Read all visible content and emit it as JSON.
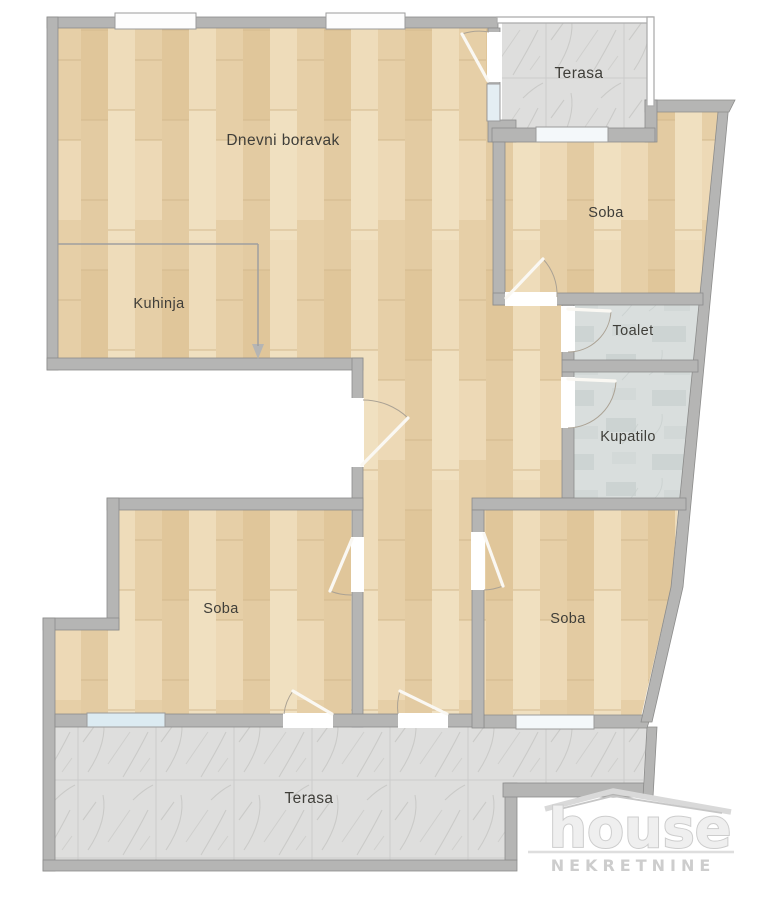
{
  "title": "Apartment floor plan",
  "plan": {
    "rooms": [
      {
        "id": "dnevni-boravak",
        "label": "Dnevni boravak"
      },
      {
        "id": "kuhinja",
        "label": "Kuhinja"
      },
      {
        "id": "terasa-top",
        "label": "Terasa"
      },
      {
        "id": "soba-top-right",
        "label": "Soba"
      },
      {
        "id": "toalet",
        "label": "Toalet"
      },
      {
        "id": "kupatilo",
        "label": "Kupatilo"
      },
      {
        "id": "soba-bottom-left",
        "label": "Soba"
      },
      {
        "id": "soba-bottom-right",
        "label": "Soba"
      },
      {
        "id": "terasa-bottom",
        "label": "Terasa"
      }
    ],
    "colors": {
      "wall": "#b5b5b4",
      "wall_outline": "#8c8c8b",
      "wood_floor": "#e8d3ae",
      "terrace_tile": "#dededd",
      "bath_tile": "#d9dedd",
      "window_glass": "#ddeaf2",
      "label_text": "#3f3e39",
      "logo_gray": "#d6d6d6"
    }
  },
  "logo": {
    "brand": "house",
    "tagline": "NEKRETNINE"
  }
}
